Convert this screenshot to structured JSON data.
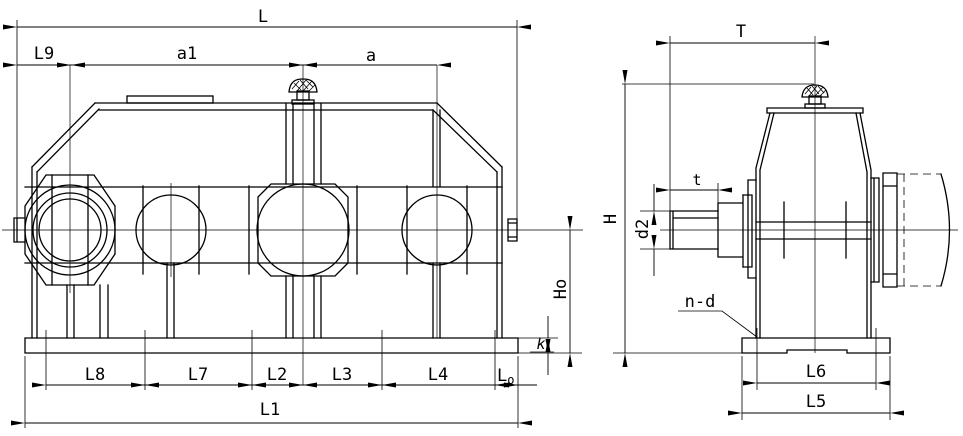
{
  "colors": {
    "ink": "#000000",
    "background": "#ffffff"
  },
  "labels": {
    "overall_length": "L",
    "l9": "L9",
    "a1": "a1",
    "a": "a",
    "t_upper": "T",
    "t_lower": "t",
    "h": "H",
    "ho": "Ho",
    "d2": "d2",
    "k": "k",
    "n_d": "n-d",
    "l8": "L8",
    "l7": "L7",
    "l2": "L2",
    "l3": "L3",
    "l4": "L4",
    "lo_base": "L",
    "lo_sub": "o",
    "l1": "L1",
    "l6": "L6",
    "l5": "L5"
  }
}
